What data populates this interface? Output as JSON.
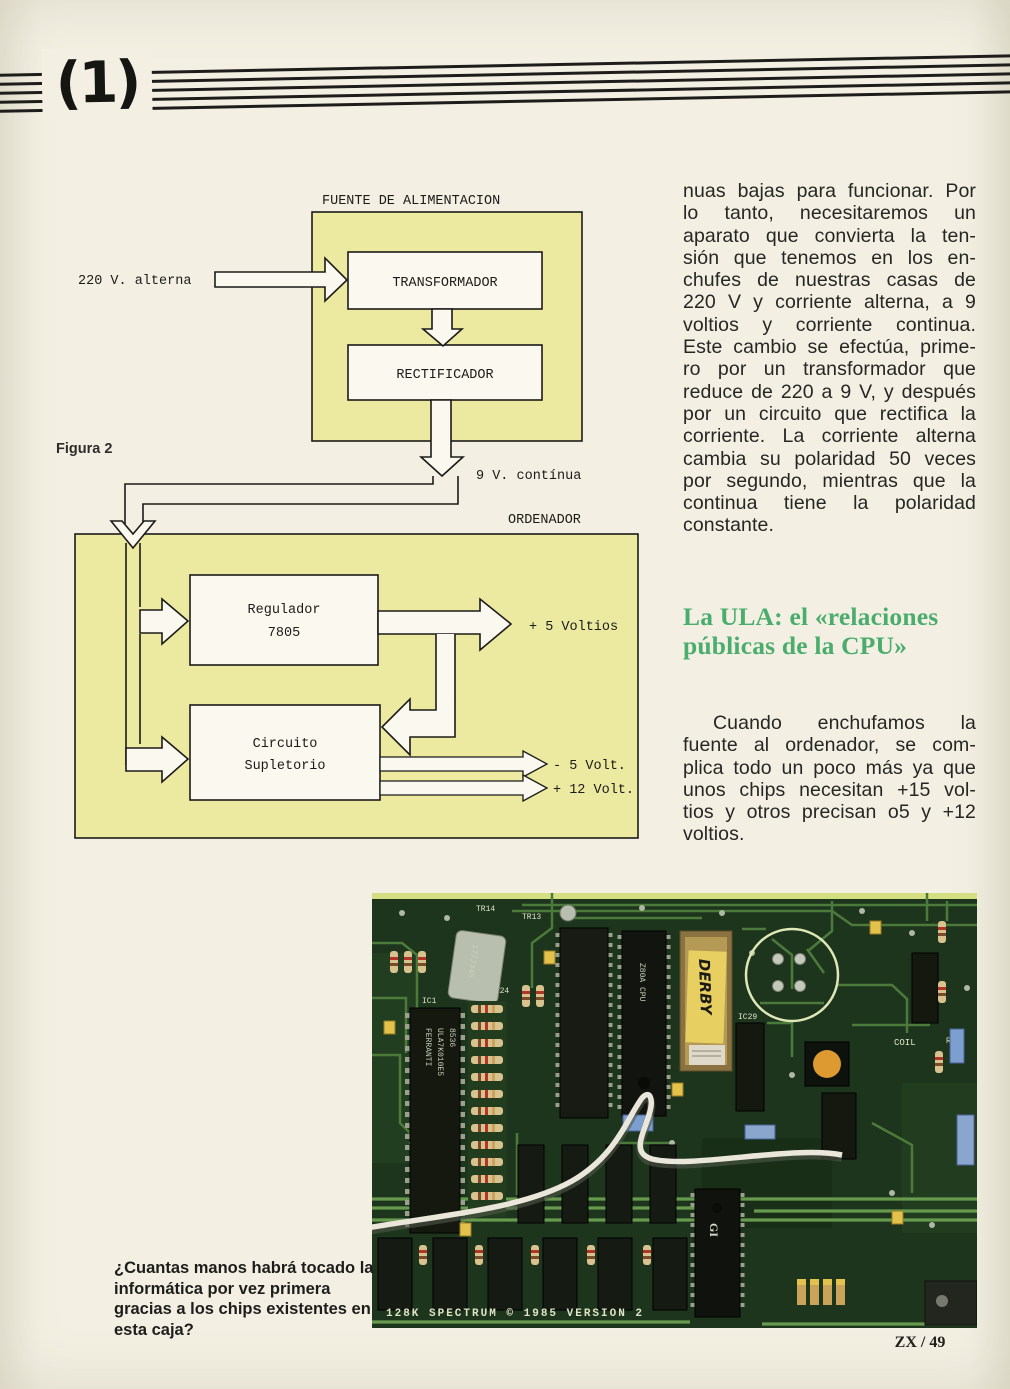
{
  "page": {
    "issue_mark": "(1)",
    "footer": "ZX / 49"
  },
  "diagram": {
    "figure_label": "Figura 2",
    "psu_title": "FUENTE DE ALIMENTACION",
    "input_label": "220 V. alterna",
    "transformer": "TRANSFORMADOR",
    "rectifier": "RECTIFICADOR",
    "dc_label": "9 V. contínua",
    "computer_title": "ORDENADOR",
    "regulator_l1": "Regulador",
    "regulator_l2": "7805",
    "supp_l1": "Circuito",
    "supp_l2": "Supletorio",
    "out_5v": "+ 5 Voltios",
    "out_m5v": "- 5 Volt.",
    "out_12v": "+ 12 Volt."
  },
  "article": {
    "p1_lines": [
      "nuas bajas para funcionar. Por",
      "lo tanto, necesitaremos un",
      "aparato que convierta la ten-",
      "sión que tenemos en los en-",
      "chufes de nuestras casas de",
      "220 V y corriente alterna, a 9",
      "voltios y corriente continua.",
      "Este cambio se efectúa, prime-",
      "ro por un transformador que",
      "reduce de 220 a 9 V, y después",
      "por un circuito que rectifica la",
      "corriente. La corriente alterna",
      "cambia su polaridad 50 veces",
      "por segundo, mientras que la",
      "continua tiene la polaridad",
      "constante."
    ],
    "heading_lines": [
      "La ULA: el «relaciones",
      "públicas de la CPU»"
    ],
    "p2_lines": [
      "Cuando enchufamos la",
      "fuente al ordenador, se com-",
      "plica todo un poco más ya que",
      "unos chips necesitan +15 vol-",
      "tios y otros precisan o5 y +12",
      "voltios."
    ]
  },
  "photo": {
    "caption_lines": [
      "¿Cuantas manos habrá tocado la",
      "informática por vez primera",
      "gracias a los chips existentes en",
      "esta caja?"
    ],
    "silkscreen": "128K SPECTRUM © 1985 VERSION 2",
    "labels": {
      "ula_brand": "FERRANTI",
      "ula_part": "ULA7K010E5",
      "ula_date": "8536",
      "cpu": "Z80A CPU",
      "rom_sticker": "DERBY",
      "coil": "COIL",
      "tr14": "TR14",
      "tr13": "TR13",
      "ic1": "IC1",
      "c124": "C124",
      "ic29": "IC29",
      "r60": "R60",
      "keypad_l1": "KEY",
      "keypad_l2": "PAD",
      "crystal": "1772345"
    }
  },
  "colors": {
    "paper": "#f2efe2",
    "diagram_yellow": "#ece9a1",
    "heading_green": "#4aad6d",
    "pcb_green": "#1d351d"
  }
}
